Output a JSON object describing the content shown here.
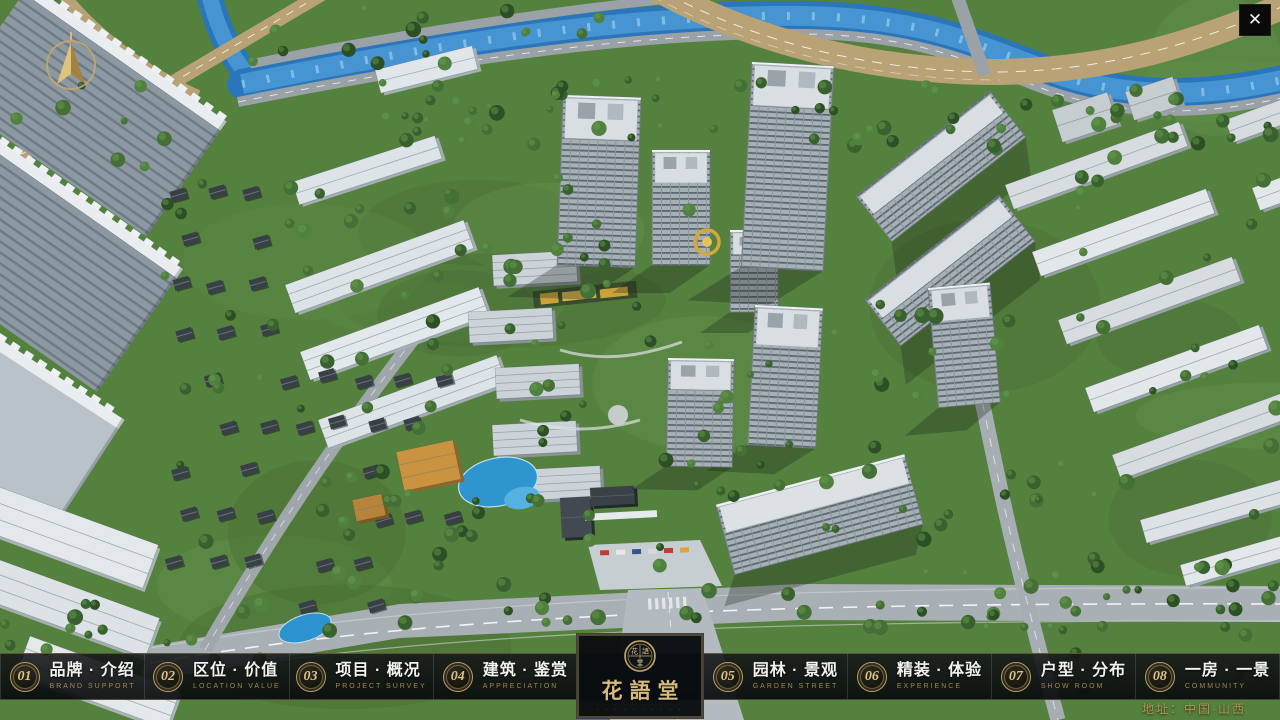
{
  "app": {
    "close_glyph": "✕"
  },
  "nav": {
    "items": [
      {
        "num": "01",
        "zh": "品牌 · 介绍",
        "en": "BRAND SUPPORT"
      },
      {
        "num": "02",
        "zh": "区位 · 价值",
        "en": "LOCATION VALUE"
      },
      {
        "num": "03",
        "zh": "项目 · 概况",
        "en": "PROJECT SURVEY"
      },
      {
        "num": "04",
        "zh": "建筑 · 鉴赏",
        "en": "APPRECIATION"
      },
      {
        "num": "05",
        "zh": "园林 · 景观",
        "en": "GARDEN STREET"
      },
      {
        "num": "06",
        "zh": "精装 · 体验",
        "en": "EXPERIENCE"
      },
      {
        "num": "07",
        "zh": "户型 · 分布",
        "en": "SHOW ROOM"
      },
      {
        "num": "08",
        "zh": "一房 · 一景",
        "en": "COMMUNITY"
      }
    ]
  },
  "logo": {
    "title": "花語堂",
    "seal_chars": "花語堂",
    "tagline_illegible": "· · · · · · · · · ·"
  },
  "footer": {
    "address": "地址：中国·山西"
  },
  "scene": {
    "description": "aerial 3D masterplan rendering of residential community",
    "colors": {
      "gold": "#c9a96a",
      "green": "#55813e",
      "river": "#2b76ba",
      "navbar": "#0b0d0f"
    }
  }
}
